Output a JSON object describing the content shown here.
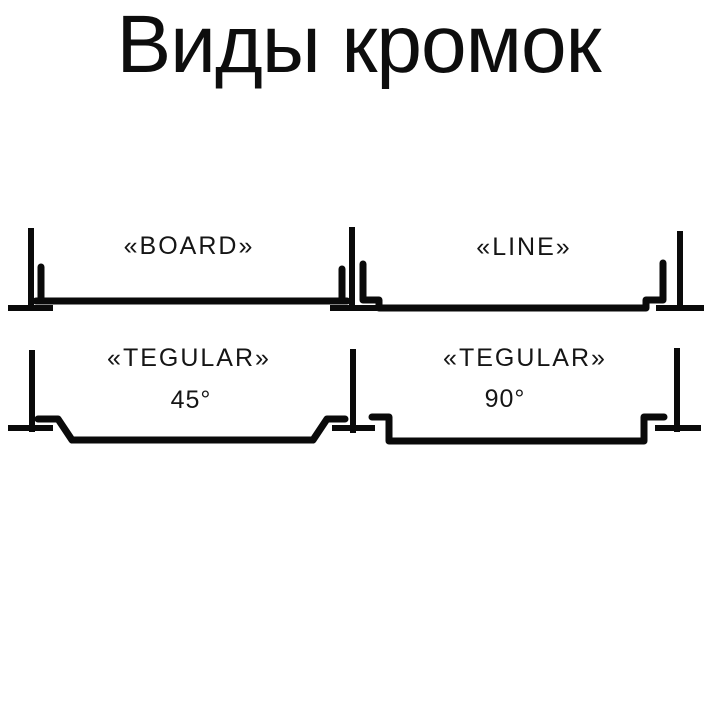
{
  "page": {
    "title": "Виды кромок",
    "background_color": "#ffffff",
    "line_color": "#0a0a0a"
  },
  "diagrams": [
    {
      "id": "board",
      "label": "«BOARD»"
    },
    {
      "id": "line",
      "label": "«LINE»"
    },
    {
      "id": "tegular-45",
      "label": "«TEGULAR»",
      "angle": "45°"
    },
    {
      "id": "tegular-90",
      "label": "«TEGULAR»",
      "angle": "90°"
    }
  ]
}
